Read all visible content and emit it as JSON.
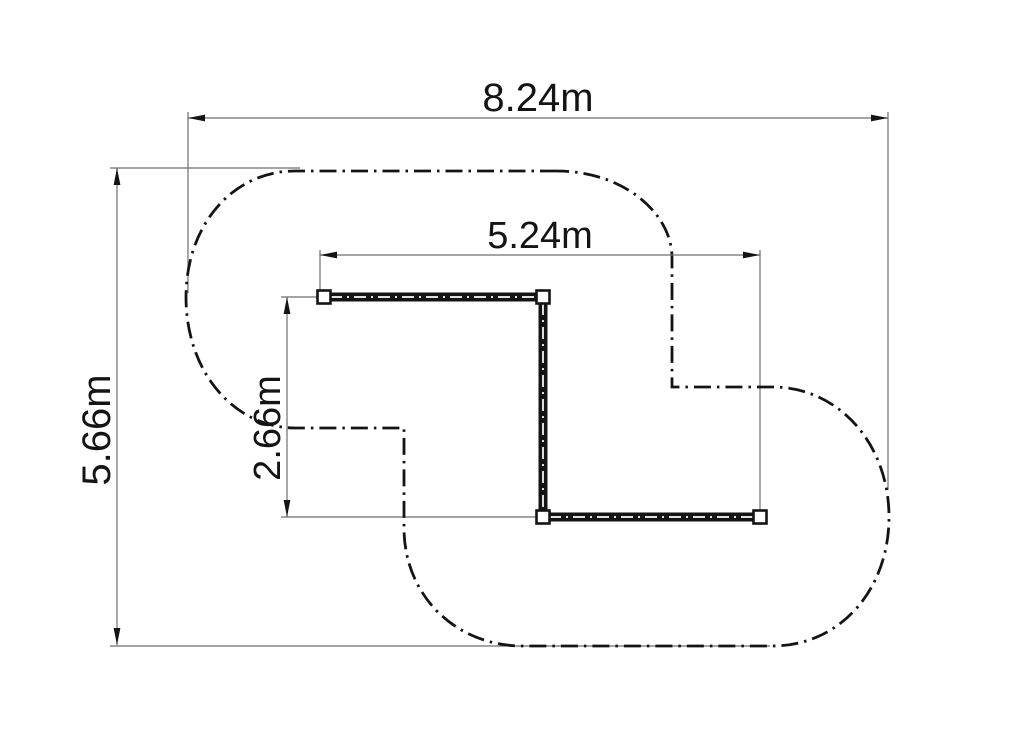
{
  "drawing": {
    "type": "technical-plan-with-path",
    "dimensions": [
      {
        "id": "overall-width",
        "label": "8.24m",
        "orientation": "horizontal"
      },
      {
        "id": "overall-height",
        "label": "5.66m",
        "orientation": "vertical"
      },
      {
        "id": "inner-width",
        "label": "5.24m",
        "orientation": "horizontal"
      },
      {
        "id": "inner-height",
        "label": "2.66m",
        "orientation": "vertical"
      }
    ],
    "colors": {
      "ink": "#141414",
      "dim_line": "#6e6e6e",
      "background": "#ffffff"
    }
  }
}
